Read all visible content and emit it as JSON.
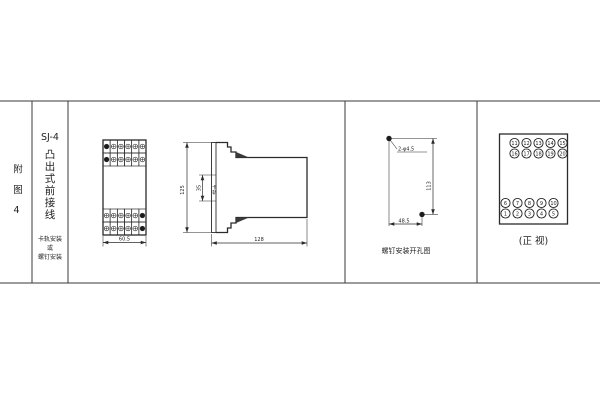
{
  "figure_block": {
    "label": "附图4"
  },
  "model_block": {
    "model": "SJ-4",
    "wiring_type": "凸出式前接线",
    "mount_lines": [
      "卡轨安装",
      "或",
      "螺钉安装"
    ]
  },
  "outline_drawing": {
    "front": {
      "width_dim": "60.5",
      "grid": {
        "rows": 2,
        "cols": 6
      }
    },
    "side": {
      "height_dim": "125",
      "rail_slot_dim": "35",
      "rail_slot_label": "卡轨",
      "depth_dim": "128"
    }
  },
  "hole_diagram": {
    "holes_label": "2-φ4.5",
    "vertical_spacing": "113",
    "horizontal_spacing": "48.5",
    "caption": "螺钉安装开孔图"
  },
  "terminal_view": {
    "upper_rows": [
      [
        "11",
        "12",
        "13",
        "14",
        "15"
      ],
      [
        "16",
        "17",
        "18",
        "19",
        "20"
      ]
    ],
    "lower_rows": [
      [
        "6",
        "7",
        "8",
        "9",
        "10"
      ],
      [
        "1",
        "2",
        "3",
        "4",
        "5"
      ]
    ],
    "caption": "(正 视)"
  },
  "colors": {
    "line": "#2b2b2b",
    "background": "#ffffff"
  }
}
